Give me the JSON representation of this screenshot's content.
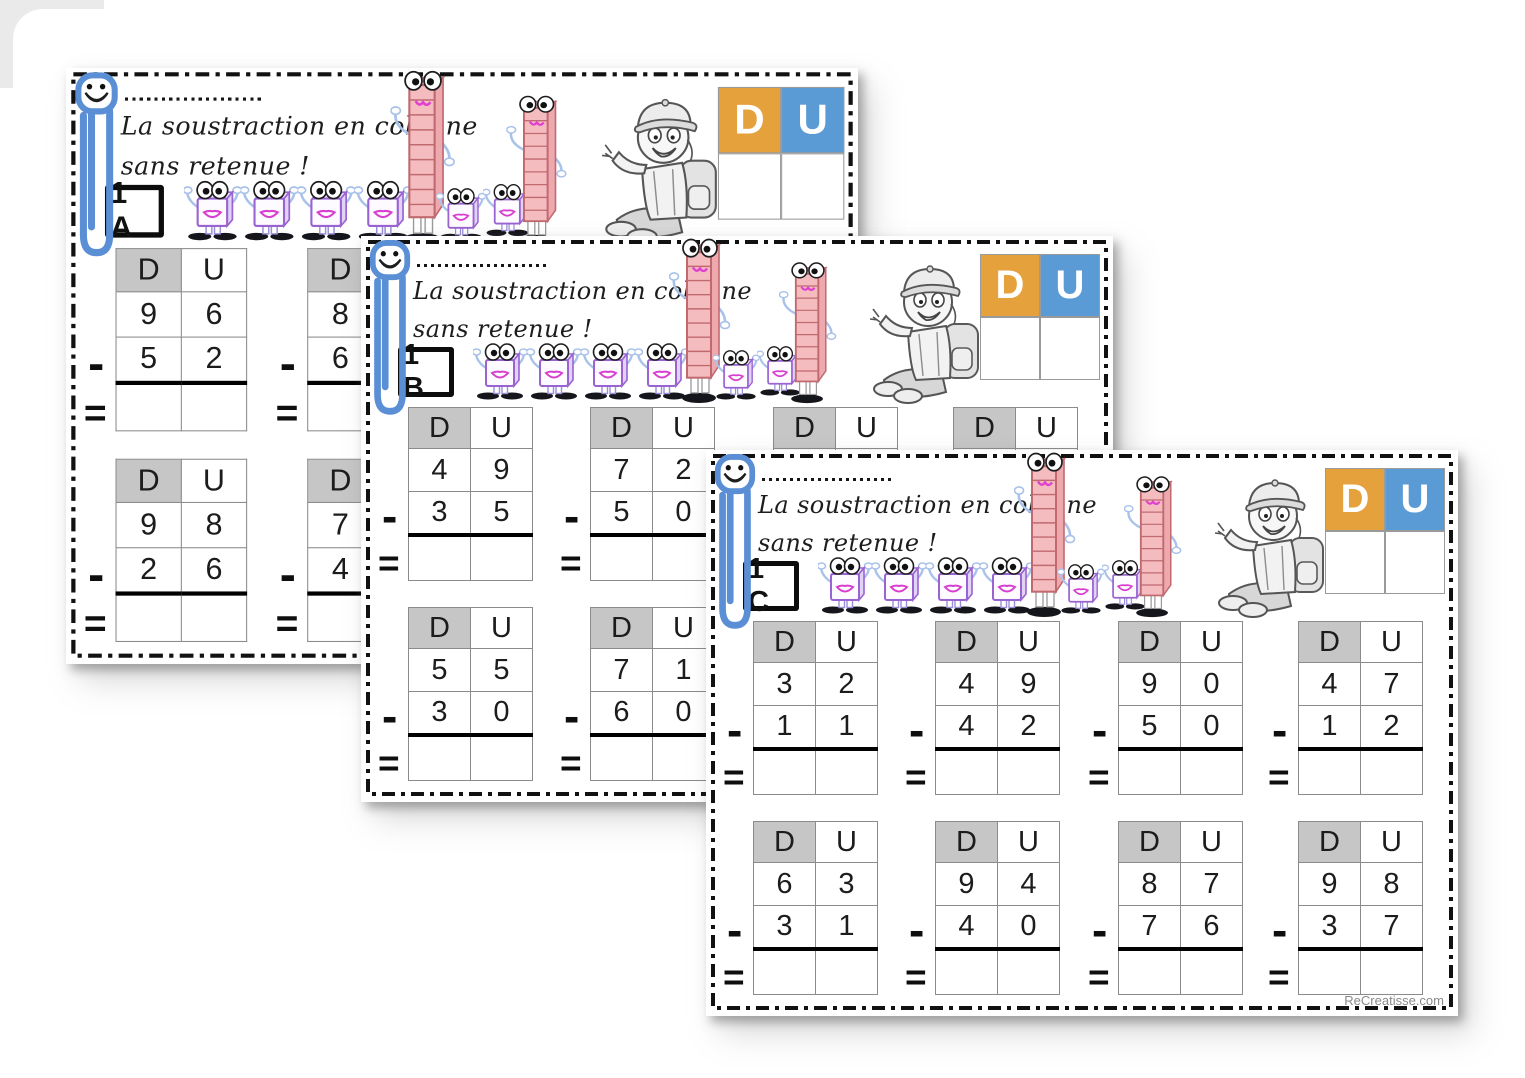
{
  "shared": {
    "title_line1": "La soustraction en colonne",
    "title_line2": "sans retenue !",
    "du": {
      "d": "D",
      "u": "U"
    },
    "minus": "-",
    "equals": "=",
    "watermark": "ReCreatisse.com",
    "colors": {
      "d_cell": "#E5A23C",
      "u_cell": "#5B9BD5",
      "header_cell": "#C6C6C6",
      "paperclip_blue": "#5A8FD6",
      "rod_pink": "#F5BCBF",
      "cube_purple": "#9A63D2"
    }
  },
  "pages": [
    {
      "label": "1 A",
      "problems": [
        {
          "top": [
            "9",
            "6"
          ],
          "bottom": [
            "5",
            "2"
          ]
        },
        {
          "top": [
            "8"
          ],
          "bottom": [
            "6"
          ]
        },
        {
          "top": [
            "9",
            "8"
          ],
          "bottom": [
            "2",
            "6"
          ]
        },
        {
          "top": [
            "7"
          ],
          "bottom": [
            "4"
          ]
        }
      ]
    },
    {
      "label": "1 B",
      "problems": [
        {
          "top": [
            "4",
            "9"
          ],
          "bottom": [
            "3",
            "5"
          ]
        },
        {
          "top": [
            "7",
            "2"
          ],
          "bottom": [
            "5",
            "0"
          ]
        },
        {},
        {},
        {
          "top": [
            "5",
            "5"
          ],
          "bottom": [
            "3",
            "0"
          ]
        },
        {
          "top": [
            "7",
            "1"
          ],
          "bottom": [
            "6",
            "0"
          ]
        }
      ]
    },
    {
      "label": "1 C",
      "problems": [
        {
          "top": [
            "3",
            "2"
          ],
          "bottom": [
            "1",
            "1"
          ]
        },
        {
          "top": [
            "4",
            "9"
          ],
          "bottom": [
            "4",
            "2"
          ]
        },
        {
          "top": [
            "9",
            "0"
          ],
          "bottom": [
            "5",
            "0"
          ]
        },
        {
          "top": [
            "4",
            "7"
          ],
          "bottom": [
            "1",
            "2"
          ]
        },
        {
          "top": [
            "6",
            "3"
          ],
          "bottom": [
            "3",
            "1"
          ]
        },
        {
          "top": [
            "9",
            "4"
          ],
          "bottom": [
            "4",
            "0"
          ]
        },
        {
          "top": [
            "8",
            "7"
          ],
          "bottom": [
            "7",
            "6"
          ]
        },
        {
          "top": [
            "9",
            "8"
          ],
          "bottom": [
            "3",
            "7"
          ]
        }
      ]
    }
  ]
}
